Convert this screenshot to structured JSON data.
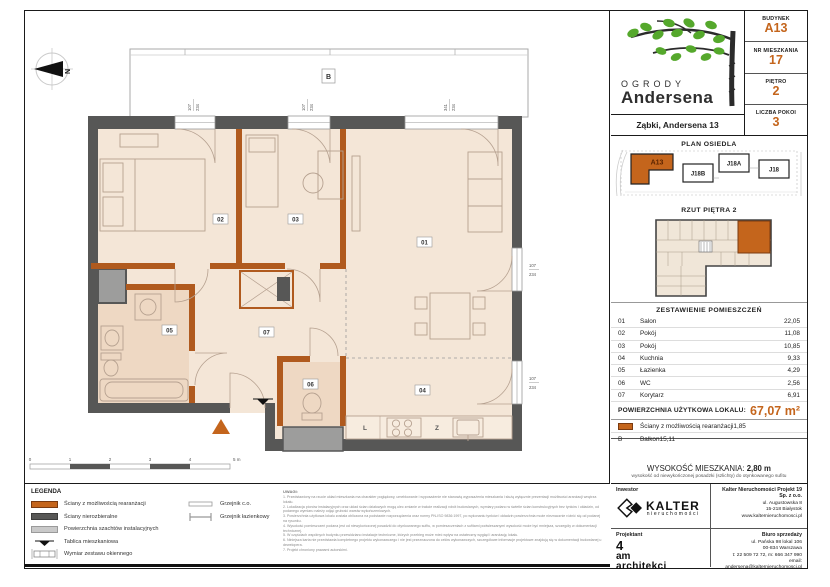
{
  "colors": {
    "accent": "#c4651c",
    "wall_dark": "#575756",
    "wall_orange": "#b05a1e",
    "shaft_gray": "#9d9d9c",
    "floor": "#f4e6d7",
    "wet_floor": "#eed8c3",
    "leaf_green": "#55a82c"
  },
  "header": {
    "logo_line1": "OGRODY",
    "logo_line2": "Andersena",
    "address": "Ząbki, Andersena 13",
    "fields": [
      {
        "label": "BUDYNEK",
        "value": "A13"
      },
      {
        "label": "NR MIESZKANIA",
        "value": "17"
      },
      {
        "label": "PIĘTRO",
        "value": "2"
      },
      {
        "label": "LICZBA POKOI",
        "value": "3"
      }
    ]
  },
  "site_plan": {
    "title": "PLAN OSIEDLA",
    "buildings": {
      "a13": "A13",
      "j18b": "J18B",
      "j18a": "J18A",
      "j18": "J18"
    }
  },
  "floor_thumb": {
    "title": "RZUT PIĘTRA 2"
  },
  "rooms_table": {
    "title": "ZESTAWIENIE POMIESZCZEŃ",
    "rows": [
      {
        "no": "01",
        "name": "Salon",
        "area": "22,05"
      },
      {
        "no": "02",
        "name": "Pokój",
        "area": "11,08"
      },
      {
        "no": "03",
        "name": "Pokój",
        "area": "10,85"
      },
      {
        "no": "04",
        "name": "Kuchnia",
        "area": "9,33"
      },
      {
        "no": "05",
        "name": "Łazienka",
        "area": "4,29"
      },
      {
        "no": "06",
        "name": "WC",
        "area": "2,56"
      },
      {
        "no": "07",
        "name": "Korytarz",
        "area": "6,91"
      }
    ],
    "total_label": "POWIERZCHNIA UŻYTKOWA LOKALU:",
    "total_value": "67,07 m²",
    "extra": [
      {
        "no": "",
        "name": "Ściany z możliwością rearanżacji",
        "area": "1,85"
      },
      {
        "no": "B",
        "name": "Balkon",
        "area": "15,11"
      }
    ]
  },
  "height_info": {
    "label": "WYSOKOŚĆ MIESZKANIA:",
    "value": "2,80 m",
    "note": "wysokość od niewykończonej posadzki (szlichty) do otynkowanego sufitu"
  },
  "contact": {
    "investor_label": "Inwestor",
    "kalter_name": "KALTER",
    "kalter_sub": "nieruchomości",
    "company": "Kalter Nieruchomości Projekt 19 Sp. z o.o.",
    "company_addr": [
      "ul. Augustowska 8",
      "15-218 Białystok",
      "www.kalternieruchomosci.pl"
    ],
    "designer_label": "Projektant",
    "designer": [
      "4",
      "am",
      "architekci"
    ],
    "sales_label": "Biuro sprzedaży",
    "sales_addr": [
      "ul. Pańska 98 lokal 106",
      "00-834 Warszawa",
      "t: 22 509 72 72, m: 666 347 990",
      "email: andersena@kalternieruchomosci.pl"
    ]
  },
  "legend": {
    "title": "LEGENDA",
    "left": [
      {
        "label": "Ściany z możliwością rearanżacji"
      },
      {
        "label": "Ściany nierozbieralne"
      },
      {
        "label": "Powierzchnia szachtów instalacyjnych"
      },
      {
        "label": "Tablica mieszkaniowa"
      },
      {
        "label": "Wymiar zestawu okiennego"
      }
    ],
    "right": [
      {
        "label": "Grzejnik c.o."
      },
      {
        "label": "Grzejnik łazienkowy"
      }
    ]
  },
  "notes": {
    "title": "UWAGI:",
    "lines": [
      "1.  Przedstawiony na rzucie układ mieszkania ma charakter poglądowy, umeblowanie i wyposażenie nie stanowią wyposażenia mieszkania i służą wyłącznie prezentacji możliwości aranżacji wnętrza lokalu.",
      "2.  Lokalizacja pionów instalacyjnych oraz układ ścian działowych mogą ulec zmianie w trakcie realizacji robót budowlanych, wymiary podano w świetle ścian konstrukcyjnych bez tynków i okładzin, od podanego wymiaru należy odjąć grubość warstw wykończeniowych.",
      "3.  Powierzchnia użytkowa lokalu została obliczona na podstawie rozporządzenia oraz normy PN-ISO 9836:1997, po wykonaniu tynków i okładzin powierzchnia może nieznacznie różnić się od podanej na rysunku.",
      "4.  Wysokość pomieszczeń podana jest od niewykończonej posadzki do otynkowanego sufitu, w pomieszczeniach z sufitami podwieszanymi wysokość może być mniejsza, szczegóły w dokumentacji technicznej.",
      "5.  W częściach wspólnych budynku przewidziano instalacje techniczne, których przebieg może mieć wpływ na ostateczny wygląd i aranżację lokalu.",
      "6.  Niniejsza karta nie przedstawia kompletnego projektu wykonawczego i nie jest przeznaczona do celów wykonawczych, szczegółowe informacje projektowe znajdują się w dokumentacji budowlanej u dewelopera.",
      "7.  Projekt chroniony prawami autorskimi."
    ]
  },
  "plan": {
    "compass": "N",
    "balcony": "B",
    "rooms": {
      "r01": "01",
      "r02": "02",
      "r03": "03",
      "r04": "04",
      "r05": "05",
      "r06": "06",
      "r07": "07"
    },
    "kitchen": {
      "fridge": "L",
      "sink": "Z"
    },
    "windows": {
      "top1": {
        "w": "107",
        "h": "234"
      },
      "top2": {
        "w": "107",
        "h": "234"
      },
      "top3": {
        "w": "341",
        "h": "234"
      },
      "right1": {
        "w": "107",
        "h": "234"
      },
      "right2": {
        "w": "107",
        "h": "234"
      }
    },
    "scale": [
      "0",
      "1",
      "2",
      "3",
      "4",
      "5 m"
    ]
  }
}
